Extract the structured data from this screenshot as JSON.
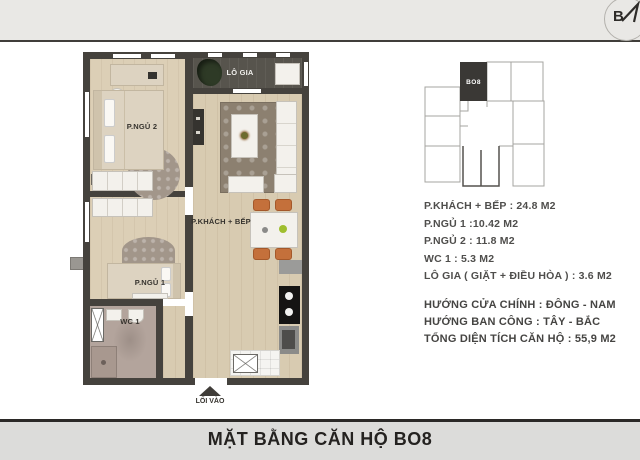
{
  "compass": {
    "letter": "B"
  },
  "key_plan": {
    "unit_label": "BO8"
  },
  "floor_plan": {
    "labels": {
      "bedroom2": "P.NGỦ 2",
      "loggia": "LÔ GIA",
      "living_kitchen": "P.KHÁCH + BẾP",
      "bedroom1": "P.NGỦ 1",
      "wc": "WC 1",
      "entrance": "LỐI VÀO"
    }
  },
  "info": {
    "area_lines": [
      "P.KHÁCH + BẾP : 24.8 M2",
      "P.NGỦ 1 :10.42 M2",
      "P.NGỦ 2 : 11.8 M2",
      "WC 1 : 5.3 M2",
      "LÔ GIA ( GIẶT + ĐIỀU HÒA ) : 3.6 M2"
    ],
    "detail_lines": [
      "HƯỚNG CỬA CHÍNH : ĐÔNG - NAM",
      "HƯỚNG BAN CÔNG  : TÂY - BẮC",
      "TỔNG DIỆN TÍCH CĂN HỘ : 55,9 M2"
    ]
  },
  "footer": {
    "title": "MẶT BẰNG CĂN HỘ BO8"
  },
  "colors": {
    "wall": "#45423d",
    "wood_floor": "#d8cbb1",
    "loggia_floor": "#57544d",
    "wc_floor": "#b3a49c",
    "accent_orange": "#c4703b",
    "accent_green": "#9fbe2e",
    "header_band": "#e9e8e5",
    "title_band": "#dcdcda",
    "highlight_unit": "#3a3835"
  }
}
